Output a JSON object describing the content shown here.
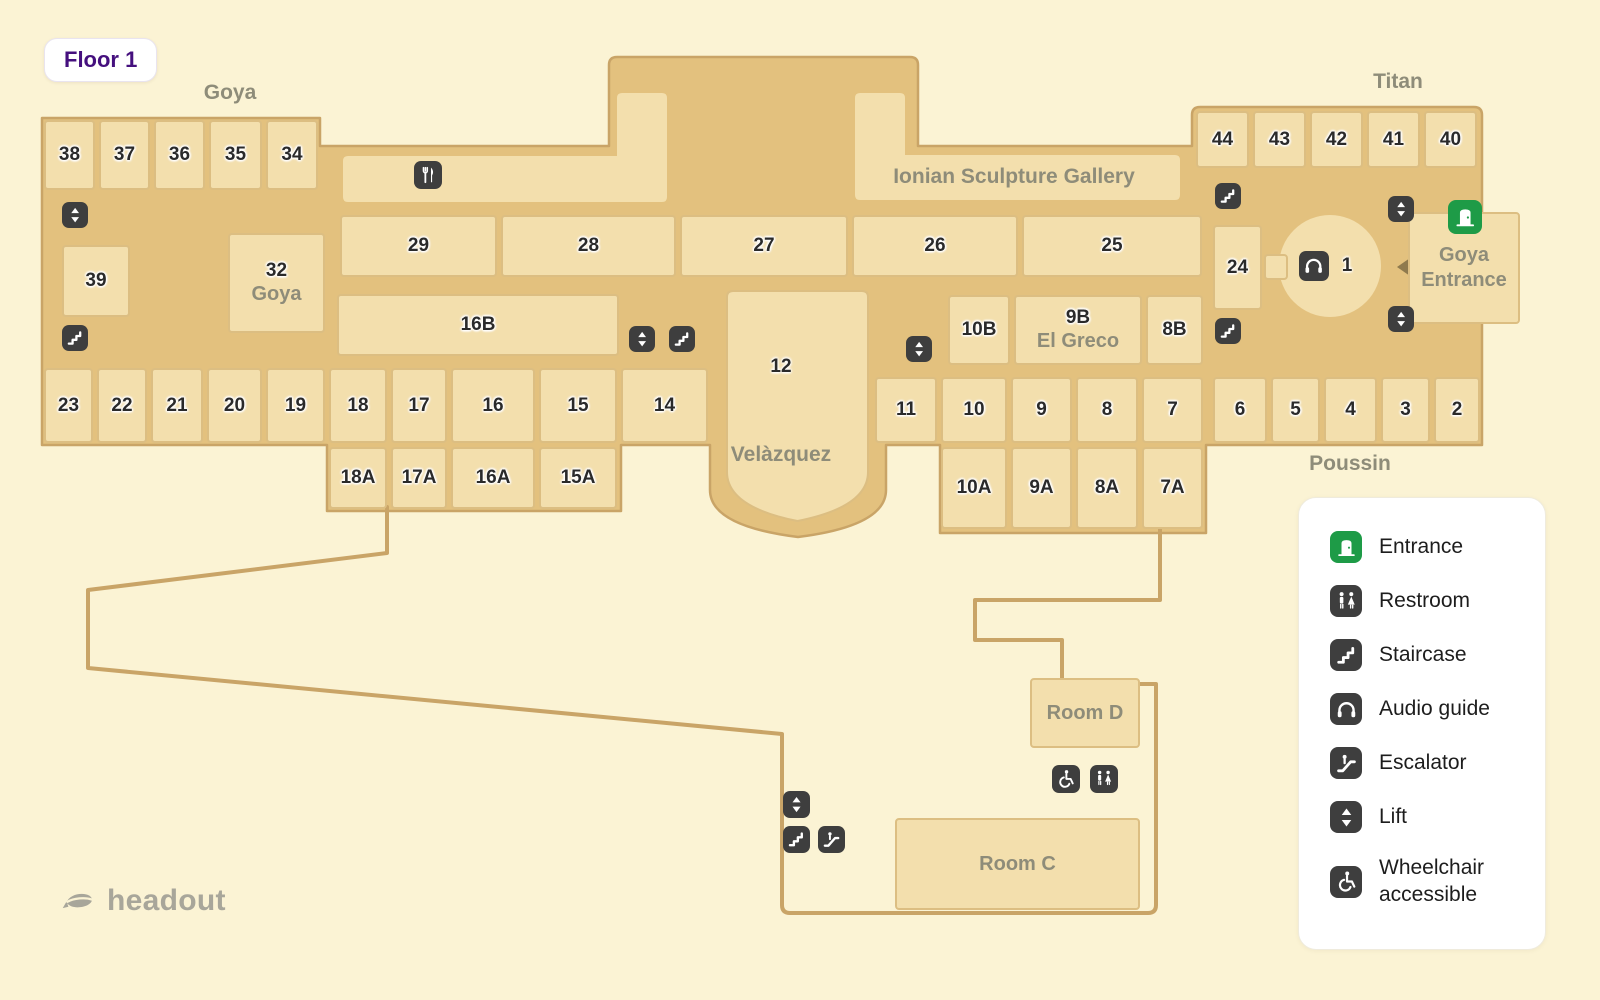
{
  "badge": {
    "label": "Floor 1"
  },
  "branding": {
    "logo_text": "headout"
  },
  "colors": {
    "background": "#FBF3D4",
    "corridor": "#E3C17E",
    "room_fill": "#F3DFAD",
    "room_border": "#DCBE82",
    "path_outline": "#C9A467",
    "icon_chip": "#3E3E3E",
    "entrance_green": "#1E9B47",
    "room_number_text": "#2A2A2A",
    "area_label_text": "#8E8C79",
    "floor_badge_text": "#45107E",
    "logo_gray": "#A8A69A"
  },
  "map": {
    "rooms": [
      {
        "id": "38",
        "label": "38",
        "x": 44,
        "y": 120,
        "w": 51,
        "h": 70
      },
      {
        "id": "37",
        "label": "37",
        "x": 99,
        "y": 120,
        "w": 51,
        "h": 70
      },
      {
        "id": "36",
        "label": "36",
        "x": 154,
        "y": 120,
        "w": 51,
        "h": 70
      },
      {
        "id": "35",
        "label": "35",
        "x": 209,
        "y": 120,
        "w": 53,
        "h": 70
      },
      {
        "id": "34",
        "label": "34",
        "x": 266,
        "y": 120,
        "w": 52,
        "h": 70
      },
      {
        "id": "39",
        "label": "39",
        "x": 62,
        "y": 245,
        "w": 68,
        "h": 72
      },
      {
        "id": "32",
        "label": "32",
        "sublabel": "Goya",
        "x": 228,
        "y": 233,
        "w": 97,
        "h": 100
      },
      {
        "id": "29",
        "label": "29",
        "x": 340,
        "y": 215,
        "w": 157,
        "h": 62
      },
      {
        "id": "28",
        "label": "28",
        "x": 501,
        "y": 215,
        "w": 175,
        "h": 62
      },
      {
        "id": "27",
        "label": "27",
        "x": 680,
        "y": 215,
        "w": 168,
        "h": 62
      },
      {
        "id": "26",
        "label": "26",
        "x": 852,
        "y": 215,
        "w": 166,
        "h": 62
      },
      {
        "id": "25",
        "label": "25",
        "x": 1022,
        "y": 215,
        "w": 180,
        "h": 62
      },
      {
        "id": "16B",
        "label": "16B",
        "x": 337,
        "y": 294,
        "w": 282,
        "h": 62
      },
      {
        "id": "10B",
        "label": "10B",
        "x": 948,
        "y": 295,
        "w": 62,
        "h": 70
      },
      {
        "id": "9B",
        "label": "9B",
        "sublabel": "El Greco",
        "x": 1014,
        "y": 295,
        "w": 128,
        "h": 70
      },
      {
        "id": "8B",
        "label": "8B",
        "x": 1146,
        "y": 295,
        "w": 57,
        "h": 70
      },
      {
        "id": "23",
        "label": "23",
        "x": 44,
        "y": 368,
        "w": 49,
        "h": 75
      },
      {
        "id": "22",
        "label": "22",
        "x": 97,
        "y": 368,
        "w": 50,
        "h": 75
      },
      {
        "id": "21",
        "label": "21",
        "x": 151,
        "y": 368,
        "w": 52,
        "h": 75
      },
      {
        "id": "20",
        "label": "20",
        "x": 207,
        "y": 368,
        "w": 55,
        "h": 75
      },
      {
        "id": "19",
        "label": "19",
        "x": 266,
        "y": 368,
        "w": 59,
        "h": 75
      },
      {
        "id": "18",
        "label": "18",
        "x": 329,
        "y": 368,
        "w": 58,
        "h": 75
      },
      {
        "id": "17",
        "label": "17",
        "x": 391,
        "y": 368,
        "w": 56,
        "h": 75
      },
      {
        "id": "16",
        "label": "16",
        "x": 451,
        "y": 368,
        "w": 84,
        "h": 75
      },
      {
        "id": "15",
        "label": "15",
        "x": 539,
        "y": 368,
        "w": 78,
        "h": 75
      },
      {
        "id": "14",
        "label": "14",
        "x": 621,
        "y": 368,
        "w": 87,
        "h": 75
      },
      {
        "id": "18A",
        "label": "18A",
        "x": 329,
        "y": 447,
        "w": 58,
        "h": 62
      },
      {
        "id": "17A",
        "label": "17A",
        "x": 391,
        "y": 447,
        "w": 56,
        "h": 62
      },
      {
        "id": "16A",
        "label": "16A",
        "x": 451,
        "y": 447,
        "w": 84,
        "h": 62
      },
      {
        "id": "15A",
        "label": "15A",
        "x": 539,
        "y": 447,
        "w": 78,
        "h": 62
      },
      {
        "id": "11",
        "label": "11",
        "x": 875,
        "y": 377,
        "w": 62,
        "h": 66
      },
      {
        "id": "10",
        "label": "10",
        "x": 941,
        "y": 377,
        "w": 66,
        "h": 66
      },
      {
        "id": "9",
        "label": "9",
        "x": 1011,
        "y": 377,
        "w": 61,
        "h": 66
      },
      {
        "id": "8",
        "label": "8",
        "x": 1076,
        "y": 377,
        "w": 62,
        "h": 66
      },
      {
        "id": "7",
        "label": "7",
        "x": 1142,
        "y": 377,
        "w": 61,
        "h": 66
      },
      {
        "id": "10A",
        "label": "10A",
        "x": 941,
        "y": 447,
        "w": 66,
        "h": 82
      },
      {
        "id": "9A",
        "label": "9A",
        "x": 1011,
        "y": 447,
        "w": 61,
        "h": 82
      },
      {
        "id": "8A",
        "label": "8A",
        "x": 1076,
        "y": 447,
        "w": 62,
        "h": 82
      },
      {
        "id": "7A",
        "label": "7A",
        "x": 1142,
        "y": 447,
        "w": 61,
        "h": 82
      },
      {
        "id": "6",
        "label": "6",
        "x": 1213,
        "y": 377,
        "w": 54,
        "h": 66
      },
      {
        "id": "5",
        "label": "5",
        "x": 1271,
        "y": 377,
        "w": 49,
        "h": 66
      },
      {
        "id": "4",
        "label": "4",
        "x": 1324,
        "y": 377,
        "w": 53,
        "h": 66
      },
      {
        "id": "3",
        "label": "3",
        "x": 1381,
        "y": 377,
        "w": 49,
        "h": 66
      },
      {
        "id": "2",
        "label": "2",
        "x": 1434,
        "y": 377,
        "w": 46,
        "h": 66
      },
      {
        "id": "44",
        "label": "44",
        "x": 1196,
        "y": 111,
        "w": 53,
        "h": 57
      },
      {
        "id": "43",
        "label": "43",
        "x": 1253,
        "y": 111,
        "w": 53,
        "h": 57
      },
      {
        "id": "42",
        "label": "42",
        "x": 1310,
        "y": 111,
        "w": 53,
        "h": 57
      },
      {
        "id": "41",
        "label": "41",
        "x": 1367,
        "y": 111,
        "w": 53,
        "h": 57
      },
      {
        "id": "40",
        "label": "40",
        "x": 1424,
        "y": 111,
        "w": 53,
        "h": 57
      },
      {
        "id": "24",
        "label": "24",
        "x": 1213,
        "y": 225,
        "w": 49,
        "h": 85
      },
      {
        "id": "corridor-stub",
        "label": "",
        "x": 1264,
        "y": 254,
        "w": 24,
        "h": 26
      },
      {
        "id": "goya-entrance",
        "label": "Goya",
        "sublabel": "Entrance",
        "label_style": "gray",
        "x": 1408,
        "y": 212,
        "w": 112,
        "h": 112
      },
      {
        "id": "room-d",
        "label": "Room D",
        "label_style": "gray",
        "x": 1030,
        "y": 678,
        "w": 110,
        "h": 70
      },
      {
        "id": "room-c",
        "label": "Room C",
        "label_style": "gray",
        "x": 895,
        "y": 818,
        "w": 245,
        "h": 92
      }
    ],
    "labels": [
      {
        "text": "Goya",
        "x": 230,
        "y": 93,
        "style": "area"
      },
      {
        "text": "Titan",
        "x": 1398,
        "y": 82,
        "style": "area"
      },
      {
        "text": "Poussin",
        "x": 1350,
        "y": 464,
        "style": "area"
      },
      {
        "text": "Ionian Sculpture Gallery",
        "x": 1014,
        "y": 177,
        "style": "area"
      },
      {
        "text": "Velàzquez",
        "x": 781,
        "y": 455,
        "style": "area"
      },
      {
        "text": "12",
        "x": 781,
        "y": 367,
        "style": "number"
      },
      {
        "text": "1",
        "x": 1347,
        "y": 266,
        "style": "number"
      }
    ],
    "icons": [
      {
        "type": "lift",
        "x": 62,
        "y": 202,
        "s": 26
      },
      {
        "type": "stairs",
        "x": 62,
        "y": 325,
        "s": 26
      },
      {
        "type": "restaurant",
        "x": 414,
        "y": 161,
        "s": 28
      },
      {
        "type": "lift",
        "x": 629,
        "y": 326,
        "s": 26
      },
      {
        "type": "stairs",
        "x": 669,
        "y": 326,
        "s": 26
      },
      {
        "type": "lift",
        "x": 906,
        "y": 336,
        "s": 26
      },
      {
        "type": "stairs",
        "x": 1215,
        "y": 183,
        "s": 26
      },
      {
        "type": "lift",
        "x": 1388,
        "y": 196,
        "s": 26
      },
      {
        "type": "entrance",
        "x": 1448,
        "y": 200,
        "s": 34
      },
      {
        "type": "audio",
        "x": 1299,
        "y": 251,
        "s": 30
      },
      {
        "type": "lift",
        "x": 1388,
        "y": 306,
        "s": 26
      },
      {
        "type": "stairs",
        "x": 1215,
        "y": 318,
        "s": 26
      },
      {
        "type": "lift",
        "x": 783,
        "y": 791,
        "s": 27
      },
      {
        "type": "stairs",
        "x": 783,
        "y": 826,
        "s": 27
      },
      {
        "type": "escalator",
        "x": 818,
        "y": 826,
        "s": 27
      },
      {
        "type": "wheelchair",
        "x": 1052,
        "y": 765,
        "s": 28
      },
      {
        "type": "restroom",
        "x": 1090,
        "y": 765,
        "s": 28
      }
    ]
  },
  "legend": {
    "items": [
      {
        "icon": "entrance",
        "label": "Entrance"
      },
      {
        "icon": "restroom",
        "label": "Restroom"
      },
      {
        "icon": "stairs",
        "label": "Staircase"
      },
      {
        "icon": "audio",
        "label": "Audio guide"
      },
      {
        "icon": "escalator",
        "label": "Escalator"
      },
      {
        "icon": "lift",
        "label": "Lift"
      },
      {
        "icon": "wheelchair",
        "label": "Wheelchair accessible"
      }
    ]
  }
}
